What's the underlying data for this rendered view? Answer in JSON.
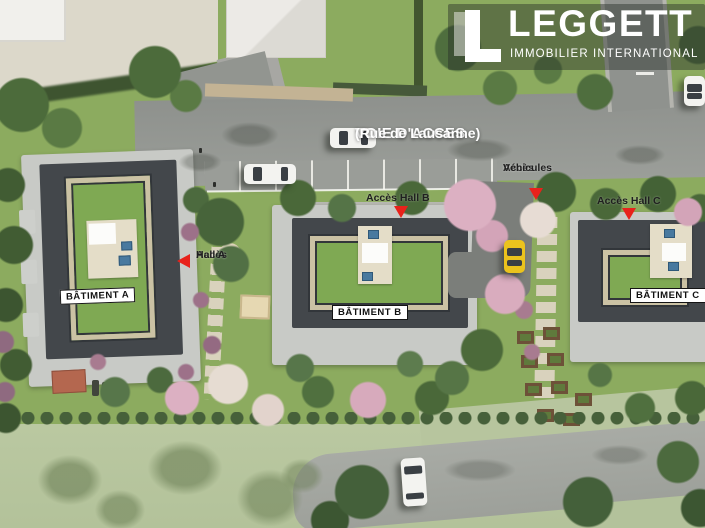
{
  "brand": {
    "name": "LEGGETT",
    "tagline": "IMMOBILIER  INTERNATIONAL"
  },
  "road": {
    "name": "VOIE D'ACCES",
    "street": "(Rue de Lausanne)"
  },
  "buildings": {
    "a": {
      "label": "BÂTIMENT A"
    },
    "b": {
      "label": "BÂTIMENT B"
    },
    "c": {
      "label": "BÂTIMENT C"
    }
  },
  "access": {
    "hall_a": {
      "line1": "Accès",
      "line2": "Hall A"
    },
    "hall_b": {
      "label": "Accès Hall B"
    },
    "vehicles": {
      "line1": "Accès",
      "line2": "Véhicules"
    },
    "hall_c": {
      "label": "Accès Hall C"
    }
  },
  "colors": {
    "arrow_red": "#e8221b",
    "label_text": "#111111",
    "brand_white": "#ffffff"
  }
}
